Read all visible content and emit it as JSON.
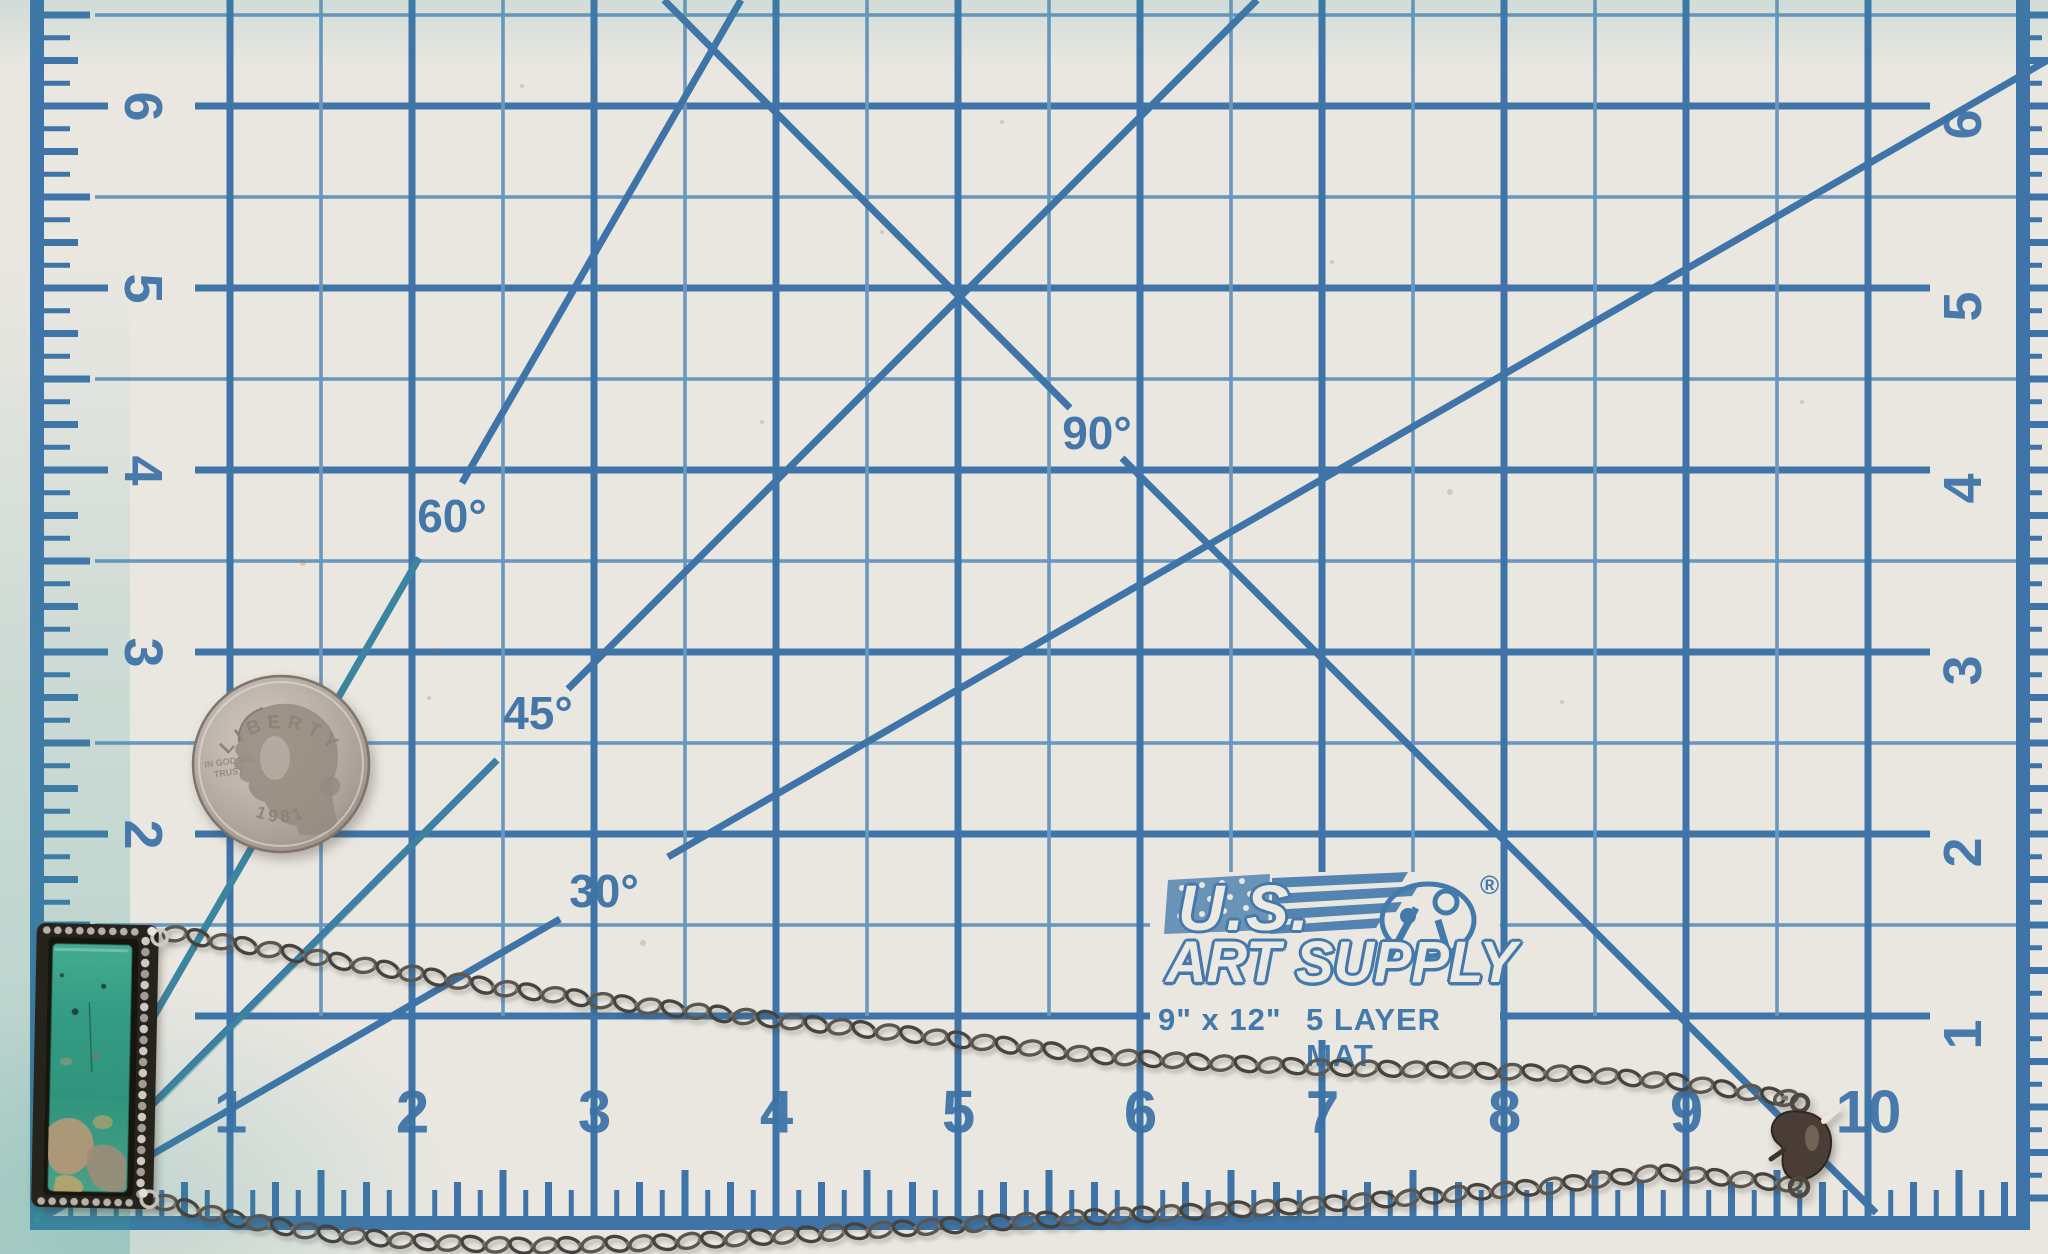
{
  "mat": {
    "surface_color": "#eae7e1",
    "grid_color": "#3e74a8",
    "grid_teal": "#3a9a96",
    "logo": {
      "brand_top": "U.S.",
      "brand_bottom": "ART SUPPLY",
      "registered": "®",
      "size": "9\" x 12\"",
      "layers": "5 LAYER MAT"
    },
    "angle_labels": [
      "30°",
      "45°",
      "60°",
      "90°"
    ],
    "rulers": {
      "left": [
        "6",
        "5",
        "4",
        "3",
        "2"
      ],
      "right": [
        "6",
        "5",
        "4",
        "3",
        "2",
        "1"
      ],
      "bottom": [
        "1",
        "2",
        "3",
        "4",
        "5",
        "6",
        "7",
        "8",
        "9",
        "10"
      ]
    }
  },
  "coin": {
    "legend": "LIBERTY",
    "motto_line1": "IN GOD WE",
    "motto_line2": "TRUST",
    "date": "1981",
    "color": "#b3aaa1"
  },
  "necklace": {
    "pendant": {
      "stone_color": "#2f957f",
      "matrix_color": "#b59878",
      "bezel_color": "#2a2623",
      "bead_color": "#c9c3bb"
    },
    "chain_color": "#53514f",
    "clasp_color": "#4a3e36"
  }
}
